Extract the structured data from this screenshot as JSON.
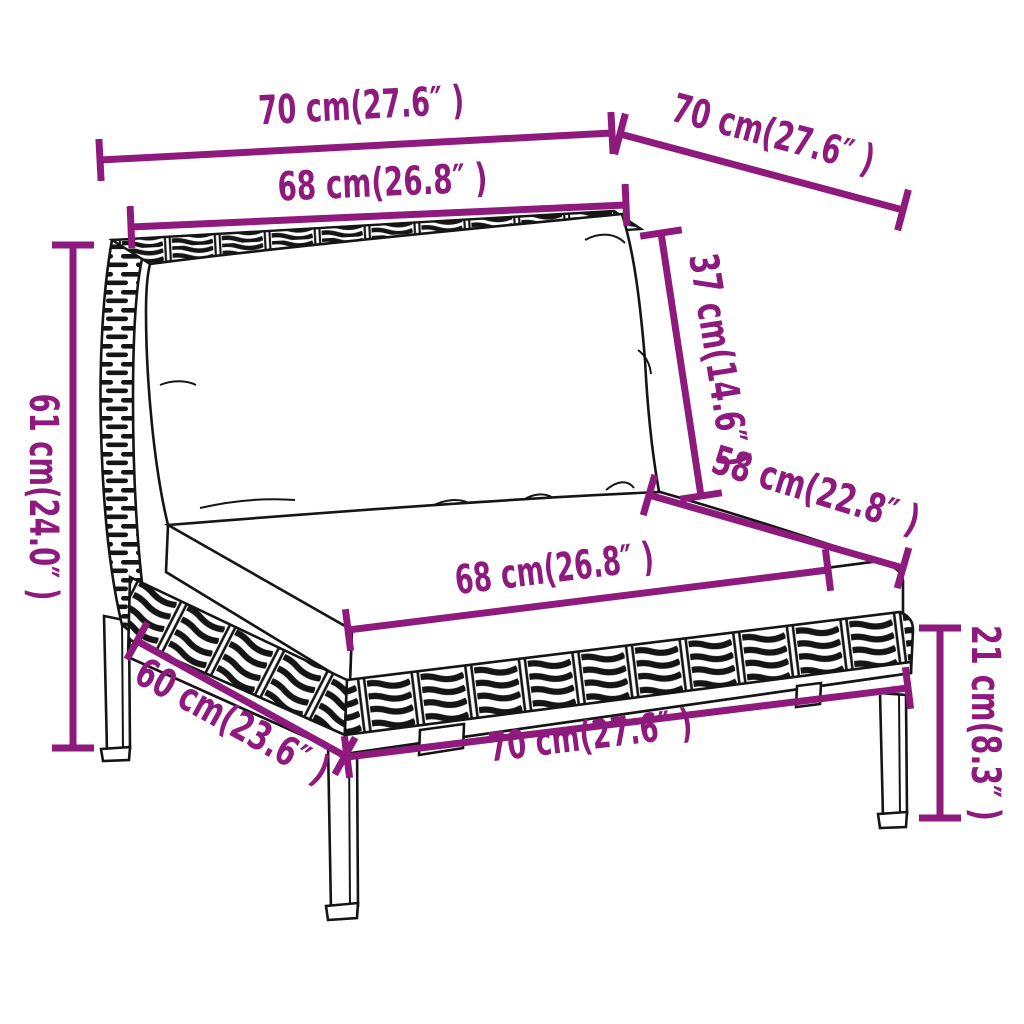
{
  "page": {
    "background": "#ffffff"
  },
  "diagram": {
    "title": "Garden sofa section dimension diagram",
    "product": "Poly rattan garden sofa middle section with back and seat cushions",
    "accent_color": "#8E1A7E",
    "line_color": "#151515"
  },
  "dimensions": {
    "top_width": {
      "label": "70 cm(27.6″ )",
      "cm": 70,
      "inches": 27.6
    },
    "top_depth": {
      "label": "70 cm(27.6″ )",
      "cm": 70,
      "inches": 27.6
    },
    "back_cushion_width": {
      "label": "68 cm(26.8″ )",
      "cm": 68,
      "inches": 26.8
    },
    "back_cushion_height": {
      "label": "37 cm(14.6″ )",
      "cm": 37,
      "inches": 14.6
    },
    "seat_depth": {
      "label": "58 cm(22.8″ )",
      "cm": 58,
      "inches": 22.8
    },
    "overall_height": {
      "label": "61 cm(24.0″ )",
      "cm": 61,
      "inches": 24.0
    },
    "seat_cushion_width": {
      "label": "68 cm(26.8″ )",
      "cm": 68,
      "inches": 26.8
    },
    "base_depth": {
      "label": "60 cm(23.6″ )",
      "cm": 60,
      "inches": 23.6
    },
    "base_width": {
      "label": "70 cm(27.6″ )",
      "cm": 70,
      "inches": 27.6
    },
    "leg_height": {
      "label": "21 cm(8.3″ )",
      "cm": 21,
      "inches": 8.3
    }
  }
}
